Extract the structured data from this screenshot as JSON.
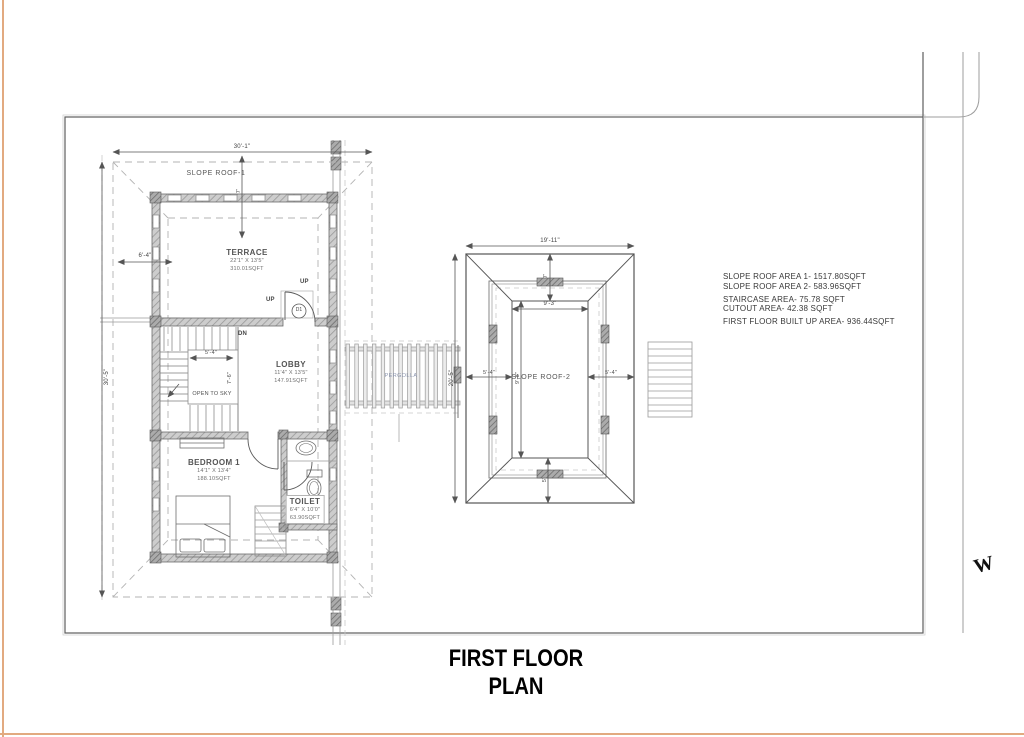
{
  "title": "FIRST FLOOR PLAN",
  "compass": {
    "west": "W"
  },
  "area_notes": {
    "slope_roof_area_1": "SLOPE ROOF  AREA 1- 1517.80SQFT",
    "slope_roof_area_2": "SLOPE ROOF  AREA 2- 583.96SQFT",
    "staircase_area": "STAIRCASE AREA- 75.78 SQFT",
    "cutout_area": "CUTOUT AREA- 42.38 SQFT",
    "built_up_area": "FIRST FLOOR BUILT UP AREA- 936.44SQFT"
  },
  "rooms": {
    "terrace": {
      "name": "TERRACE",
      "size": "22'1\" X 13'5\"",
      "area": "310.01SQFT"
    },
    "lobby": {
      "name": "LOBBY",
      "size": "11'4\" X 13'5\"",
      "area": "147.91SQFT"
    },
    "bedroom1": {
      "name": "BEDROOM 1",
      "size": "14'1\" X 13'4\"",
      "area": "188.10SQFT"
    },
    "toilet": {
      "name": "TOILET",
      "size": "6'4\" X 10'0\"",
      "area": "63.90SQFT"
    }
  },
  "zones": {
    "slope_roof_1": "SLOPE ROOF-1",
    "slope_roof_2": "SLOPE ROOF-2",
    "pergola": "PERGOLLA",
    "open_to_sky": "OPEN TO SKY"
  },
  "marks": {
    "up_terrace": "UP",
    "up_lobby": "UP",
    "down": "DN",
    "door_1": "D1"
  },
  "dimensions": {
    "plan_width": "30'-1\"",
    "roof_offset": "6'-4\"",
    "plan_height": "30'-5\"",
    "stair_well_width": "5'-4\"",
    "stair_well_height": "7'-6\"",
    "terrace_roof_drop": "7'",
    "roof2_width": "19'-11\"",
    "roof2_ridge_width": "9'-3\"",
    "roof2_ridge_drop": "7'",
    "roof2_eave_left": "5'-4\"",
    "roof2_eave_right": "5'-4\"",
    "roof2_height": "20'-5\"",
    "roof2_core_height": "9'-8\"",
    "roof2_eave_bottom": "5'"
  },
  "colors": {
    "page_border": "#e2aa80",
    "wall": "#b9b9b9",
    "dash": "#b3b3b3",
    "line_dark": "#555555"
  }
}
